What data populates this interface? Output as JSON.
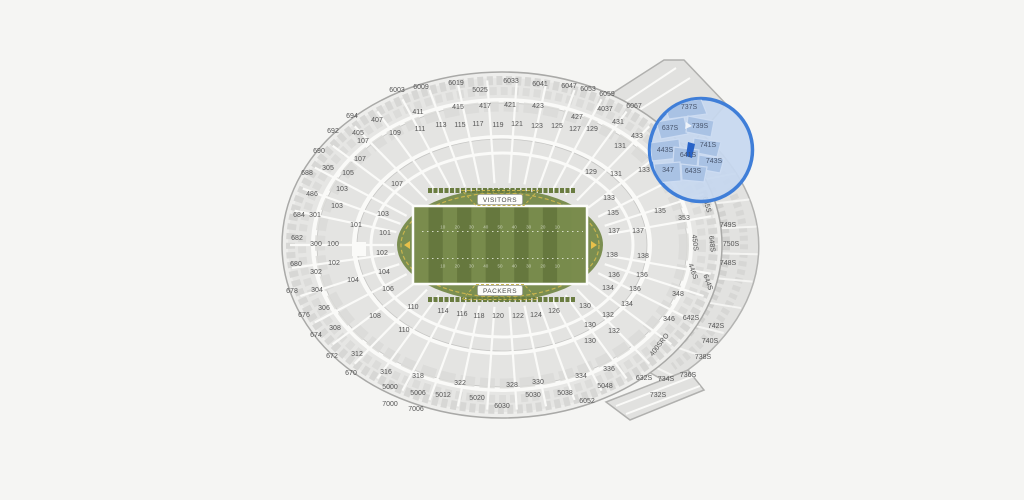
{
  "page": {
    "background": "#f5f5f3"
  },
  "field": {
    "visitor_label": "VISITORS",
    "home_label": "PACKERS",
    "yard_numbers": [
      "10",
      "20",
      "30",
      "40",
      "50",
      "40",
      "30",
      "20",
      "10"
    ],
    "colors": {
      "turf": "#7b8e51",
      "stripe_dark": "#66783e",
      "stripe_light": "#788b4c",
      "endzone": "#7a8c4d",
      "outline_yellow": "#c8b44e",
      "goalpost": "#e8c04a",
      "sideline_white": "#fdfdfb"
    }
  },
  "magnifier": {
    "stroke": "#3f7ed8",
    "fill": "#c6d7ef",
    "section_fill": "#a9c2e4",
    "section_gap": "#cddcf2",
    "selected_color": "#2863c8",
    "label_color": "#49566e"
  },
  "map": {
    "section_fill": "#e4e4e2",
    "section_stroke": "#b3b3b1",
    "label_color": "#545454",
    "labels": [
      {
        "t": "6003",
        "x": 397,
        "y": 92
      },
      {
        "t": "6009",
        "x": 421,
        "y": 89
      },
      {
        "t": "6019",
        "x": 456,
        "y": 85
      },
      {
        "t": "5025",
        "x": 480,
        "y": 92
      },
      {
        "t": "6033",
        "x": 511,
        "y": 83
      },
      {
        "t": "6041",
        "x": 540,
        "y": 86
      },
      {
        "t": "6047",
        "x": 569,
        "y": 88
      },
      {
        "t": "6053",
        "x": 588,
        "y": 91
      },
      {
        "t": "6059",
        "x": 607,
        "y": 96
      },
      {
        "t": "6067",
        "x": 634,
        "y": 108
      },
      {
        "t": "411",
        "x": 418,
        "y": 114
      },
      {
        "t": "415",
        "x": 458,
        "y": 109
      },
      {
        "t": "417",
        "x": 485,
        "y": 108
      },
      {
        "t": "421",
        "x": 510,
        "y": 107
      },
      {
        "t": "423",
        "x": 538,
        "y": 108
      },
      {
        "t": "427",
        "x": 577,
        "y": 119
      },
      {
        "t": "4037",
        "x": 605,
        "y": 111
      },
      {
        "t": "431",
        "x": 618,
        "y": 124
      },
      {
        "t": "433",
        "x": 637,
        "y": 138
      },
      {
        "t": "694",
        "x": 352,
        "y": 118
      },
      {
        "t": "692",
        "x": 333,
        "y": 133
      },
      {
        "t": "690",
        "x": 319,
        "y": 153
      },
      {
        "t": "688",
        "x": 307,
        "y": 175
      },
      {
        "t": "486",
        "x": 312,
        "y": 196
      },
      {
        "t": "684",
        "x": 299,
        "y": 217
      },
      {
        "t": "682",
        "x": 297,
        "y": 240
      },
      {
        "t": "680",
        "x": 296,
        "y": 266
      },
      {
        "t": "678",
        "x": 292,
        "y": 293
      },
      {
        "t": "676",
        "x": 304,
        "y": 317
      },
      {
        "t": "674",
        "x": 316,
        "y": 337
      },
      {
        "t": "672",
        "x": 332,
        "y": 358
      },
      {
        "t": "670",
        "x": 351,
        "y": 375
      },
      {
        "t": "305",
        "x": 328,
        "y": 170
      },
      {
        "t": "301",
        "x": 315,
        "y": 217
      },
      {
        "t": "300",
        "x": 316,
        "y": 246
      },
      {
        "t": "302",
        "x": 316,
        "y": 274
      },
      {
        "t": "304",
        "x": 317,
        "y": 292
      },
      {
        "t": "306",
        "x": 324,
        "y": 310
      },
      {
        "t": "308",
        "x": 335,
        "y": 330
      },
      {
        "t": "312",
        "x": 357,
        "y": 356
      },
      {
        "t": "316",
        "x": 386,
        "y": 374
      },
      {
        "t": "407",
        "x": 377,
        "y": 122
      },
      {
        "t": "405",
        "x": 358,
        "y": 135
      },
      {
        "t": "109",
        "x": 395,
        "y": 135
      },
      {
        "t": "107",
        "x": 363,
        "y": 143
      },
      {
        "t": "107",
        "x": 360,
        "y": 161
      },
      {
        "t": "105",
        "x": 348,
        "y": 175
      },
      {
        "t": "103",
        "x": 342,
        "y": 191
      },
      {
        "t": "103",
        "x": 337,
        "y": 208
      },
      {
        "t": "101",
        "x": 356,
        "y": 227
      },
      {
        "t": "100",
        "x": 333,
        "y": 246
      },
      {
        "t": "102",
        "x": 334,
        "y": 265
      },
      {
        "t": "104",
        "x": 353,
        "y": 282
      },
      {
        "t": "108",
        "x": 375,
        "y": 318
      },
      {
        "t": "110",
        "x": 404,
        "y": 332
      },
      {
        "t": "107",
        "x": 397,
        "y": 186
      },
      {
        "t": "103",
        "x": 383,
        "y": 216
      },
      {
        "t": "101",
        "x": 385,
        "y": 235
      },
      {
        "t": "102",
        "x": 382,
        "y": 255
      },
      {
        "t": "104",
        "x": 384,
        "y": 274
      },
      {
        "t": "106",
        "x": 388,
        "y": 291
      },
      {
        "t": "111",
        "x": 420,
        "y": 131
      },
      {
        "t": "113",
        "x": 441,
        "y": 127
      },
      {
        "t": "115",
        "x": 460,
        "y": 127
      },
      {
        "t": "117",
        "x": 478,
        "y": 126
      },
      {
        "t": "119",
        "x": 498,
        "y": 127
      },
      {
        "t": "121",
        "x": 517,
        "y": 126
      },
      {
        "t": "123",
        "x": 537,
        "y": 128
      },
      {
        "t": "125",
        "x": 557,
        "y": 128
      },
      {
        "t": "127",
        "x": 575,
        "y": 131
      },
      {
        "t": "129",
        "x": 592,
        "y": 131
      },
      {
        "t": "131",
        "x": 620,
        "y": 148
      },
      {
        "t": "129",
        "x": 591,
        "y": 174
      },
      {
        "t": "131",
        "x": 616,
        "y": 176
      },
      {
        "t": "133",
        "x": 644,
        "y": 172
      },
      {
        "t": "133",
        "x": 609,
        "y": 200
      },
      {
        "t": "135",
        "x": 613,
        "y": 215
      },
      {
        "t": "135",
        "x": 660,
        "y": 213
      },
      {
        "t": "353",
        "x": 684,
        "y": 220
      },
      {
        "t": "137",
        "x": 614,
        "y": 233
      },
      {
        "t": "137",
        "x": 638,
        "y": 233
      },
      {
        "t": "138",
        "x": 612,
        "y": 257
      },
      {
        "t": "138",
        "x": 643,
        "y": 258
      },
      {
        "t": "136",
        "x": 614,
        "y": 277
      },
      {
        "t": "136",
        "x": 642,
        "y": 277
      },
      {
        "t": "134",
        "x": 608,
        "y": 290
      },
      {
        "t": "136",
        "x": 635,
        "y": 291
      },
      {
        "t": "134",
        "x": 627,
        "y": 306
      },
      {
        "t": "130",
        "x": 585,
        "y": 308
      },
      {
        "t": "132",
        "x": 608,
        "y": 317
      },
      {
        "t": "130",
        "x": 590,
        "y": 327
      },
      {
        "t": "132",
        "x": 614,
        "y": 333
      },
      {
        "t": "130",
        "x": 590,
        "y": 343
      },
      {
        "t": "110",
        "x": 413,
        "y": 309
      },
      {
        "t": "114",
        "x": 443,
        "y": 313
      },
      {
        "t": "116",
        "x": 462,
        "y": 316
      },
      {
        "t": "118",
        "x": 479,
        "y": 318
      },
      {
        "t": "120",
        "x": 498,
        "y": 318
      },
      {
        "t": "122",
        "x": 518,
        "y": 318
      },
      {
        "t": "124",
        "x": 536,
        "y": 317
      },
      {
        "t": "126",
        "x": 554,
        "y": 313
      },
      {
        "t": "318",
        "x": 418,
        "y": 378
      },
      {
        "t": "322",
        "x": 460,
        "y": 385
      },
      {
        "t": "328",
        "x": 512,
        "y": 387
      },
      {
        "t": "330",
        "x": 538,
        "y": 384
      },
      {
        "t": "334",
        "x": 581,
        "y": 378
      },
      {
        "t": "336",
        "x": 609,
        "y": 371
      },
      {
        "t": "5000",
        "x": 390,
        "y": 389
      },
      {
        "t": "5006",
        "x": 418,
        "y": 395
      },
      {
        "t": "5012",
        "x": 443,
        "y": 397
      },
      {
        "t": "5020",
        "x": 477,
        "y": 400
      },
      {
        "t": "5030",
        "x": 533,
        "y": 397
      },
      {
        "t": "5038",
        "x": 565,
        "y": 395
      },
      {
        "t": "5048",
        "x": 605,
        "y": 388
      },
      {
        "t": "6052",
        "x": 587,
        "y": 403
      },
      {
        "t": "7000",
        "x": 390,
        "y": 406
      },
      {
        "t": "7006",
        "x": 416,
        "y": 411
      },
      {
        "t": "6030",
        "x": 502,
        "y": 408
      },
      {
        "t": "348",
        "x": 678,
        "y": 296
      },
      {
        "t": "346",
        "x": 669,
        "y": 321
      },
      {
        "t": "645S",
        "x": 705,
        "y": 205,
        "r": 75
      },
      {
        "t": "450S",
        "x": 693,
        "y": 243,
        "r": 83
      },
      {
        "t": "446S",
        "x": 691,
        "y": 272,
        "r": 70
      },
      {
        "t": "648S",
        "x": 710,
        "y": 244,
        "r": 84
      },
      {
        "t": "644S",
        "x": 706,
        "y": 283,
        "r": 70
      },
      {
        "t": "749S",
        "x": 728,
        "y": 227
      },
      {
        "t": "750S",
        "x": 731,
        "y": 246
      },
      {
        "t": "748S",
        "x": 728,
        "y": 265
      },
      {
        "t": "642S",
        "x": 691,
        "y": 320
      },
      {
        "t": "742S",
        "x": 716,
        "y": 328
      },
      {
        "t": "740S",
        "x": 710,
        "y": 343
      },
      {
        "t": "738S",
        "x": 703,
        "y": 359
      },
      {
        "t": "736S",
        "x": 688,
        "y": 377
      },
      {
        "t": "734S",
        "x": 666,
        "y": 381
      },
      {
        "t": "732S",
        "x": 658,
        "y": 397
      },
      {
        "t": "632S",
        "x": 644,
        "y": 380
      },
      {
        "t": "400SRO",
        "x": 661,
        "y": 346,
        "r": -52
      },
      {
        "t": "737S",
        "x": 689,
        "y": 109,
        "b": true
      },
      {
        "t": "637S",
        "x": 670,
        "y": 130,
        "b": true
      },
      {
        "t": "739S",
        "x": 700,
        "y": 128,
        "b": true
      },
      {
        "t": "443S",
        "x": 665,
        "y": 152,
        "b": true
      },
      {
        "t": "741S",
        "x": 708,
        "y": 147,
        "b": true
      },
      {
        "t": "641S",
        "x": 688,
        "y": 157,
        "b": true
      },
      {
        "t": "743S",
        "x": 714,
        "y": 163,
        "b": true
      },
      {
        "t": "347",
        "x": 668,
        "y": 172,
        "b": true
      },
      {
        "t": "643S",
        "x": 693,
        "y": 173,
        "b": true
      }
    ]
  }
}
